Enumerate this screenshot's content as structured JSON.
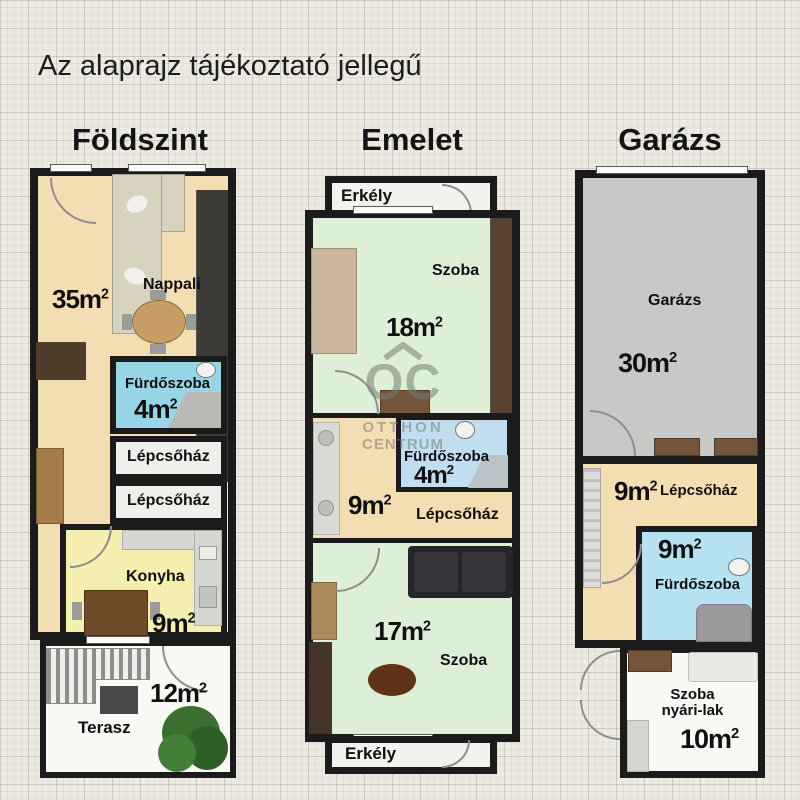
{
  "title": "Az alaprajz tájékoztató jellegű",
  "sup": "2",
  "watermark": {
    "initials": "OC",
    "line1": "OTTHON",
    "line2": "CENTRUM"
  },
  "colors": {
    "wall": "#1b1b1b",
    "floor_cream": "#f3ddb2",
    "floor_green": "#ddefd6",
    "floor_blue_bright": "#97d4e5",
    "floor_blue_light": "#c0def0",
    "floor_blue_mid": "#b6e1f1",
    "floor_yellow": "#f5eeb1",
    "floor_gray": "#c8c8c6",
    "floor_white": "#f8f8f5",
    "background": "#edeae2"
  },
  "foldszint": {
    "heading": "Földszint",
    "nappali": {
      "label": "Nappali",
      "size": "35m"
    },
    "furdoszoba": {
      "label": "Fürdőszoba",
      "size": "4m"
    },
    "lepcsohaz1": {
      "label": "Lépcsőház"
    },
    "lepcsohaz2": {
      "label": "Lépcsőház"
    },
    "konyha": {
      "label": "Konyha",
      "size": "9m"
    },
    "terasz": {
      "label": "Terasz",
      "size": "12m"
    }
  },
  "emelet": {
    "heading": "Emelet",
    "erkely_felso": {
      "label": "Erkély"
    },
    "szoba_felso": {
      "label": "Szoba",
      "size": "18m"
    },
    "furdoszoba": {
      "label": "Fürdőszoba",
      "size": "4m"
    },
    "eloter": {
      "size": "9m"
    },
    "lepcsohaz": {
      "label": "Lépcsőház"
    },
    "szoba_also": {
      "label": "Szoba",
      "size": "17m"
    },
    "erkely_also": {
      "label": "Erkély"
    }
  },
  "garazs": {
    "heading": "Garázs",
    "garazs_room": {
      "label": "Garázs",
      "size": "30m"
    },
    "lepcsohaz": {
      "label": "Lépcsőház",
      "size": "9m"
    },
    "furdoszoba": {
      "label": "Fürdőszoba",
      "size": "9m"
    },
    "szoba": {
      "label1": "Szoba",
      "label2": "nyári-lak",
      "size": "10m"
    }
  }
}
